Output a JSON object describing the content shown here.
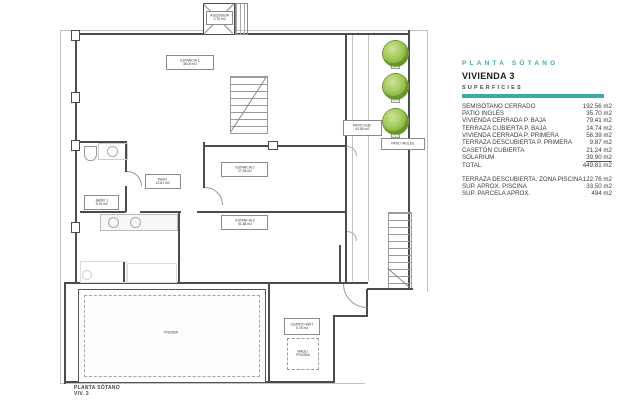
{
  "legend": {
    "plan_title": "PLANTA SÓTANO",
    "unit_title": "VIVIENDA 3",
    "section_title": "SUPERFICIES",
    "accent_color": "#3aabad",
    "rows": [
      {
        "label": "SEMISÓTANO CERRADO",
        "value": "192.56 m2"
      },
      {
        "label": "PATIO INGLÉS",
        "value": "35.70 m2"
      },
      {
        "label": "VIVIENDA CERRADA P. BAJA",
        "value": "79.41 m2"
      },
      {
        "label": "TERRAZA CUBIERTA P. BAJA",
        "value": "14.74 m2"
      },
      {
        "label": "VIVIENDA CERRADA P. PRIMERA",
        "value": "56.39 m2"
      },
      {
        "label": "TERRAZA DESCUBIERTA P. PRIMERA",
        "value": "9.87 m2"
      },
      {
        "label": "CASETÓN CUBIERTA",
        "value": "21.24 m2"
      },
      {
        "label": "SOLARIUM",
        "value": "39.90 m2"
      },
      {
        "label": "TOTAL",
        "value": "449.81 m2"
      }
    ],
    "extra_rows": [
      {
        "label": "TERRAZA DESCUBIERTA. ZONA PISCINA",
        "value": "122.76 m2"
      },
      {
        "label": "SUP. APROX. PISCINA",
        "value": "33.50 m2"
      },
      {
        "label": "SUP. PARCELA APROX.",
        "value": "494 m2"
      }
    ]
  },
  "plan": {
    "labels": {
      "ascensor": {
        "name": "ASCENSOR",
        "area": "2.70 m2"
      },
      "estancia1": {
        "name": "ESTANCIA 1",
        "area": "38.09 m2"
      },
      "bano1": {
        "name": "BAÑO 1",
        "area": "5.91 m2"
      },
      "paso": {
        "name": "PASO",
        "area": "12.81 m2"
      },
      "estancia2": {
        "name": "ESTANCIA 2",
        "area": "27.05 m2"
      },
      "estancia3": {
        "name": "ESTANCIA 3",
        "area": "41.88 m2"
      },
      "patio_cub": {
        "name": "PATIO CUB.",
        "area": "43.80 m2"
      },
      "patio_ingles": {
        "name": "PATIO INGLES",
        "area": ""
      },
      "piscina": {
        "name": "PISCINA",
        "area": ""
      },
      "cuarto_inst": {
        "name": "CUARTO INST.",
        "area": "0.78 m2"
      },
      "maqu_piscina": {
        "name": "MAQU.",
        "area": "PISCINA"
      }
    },
    "footer": {
      "line1": "PLANTA SÓTANO",
      "line2": "VIV. 3"
    }
  }
}
